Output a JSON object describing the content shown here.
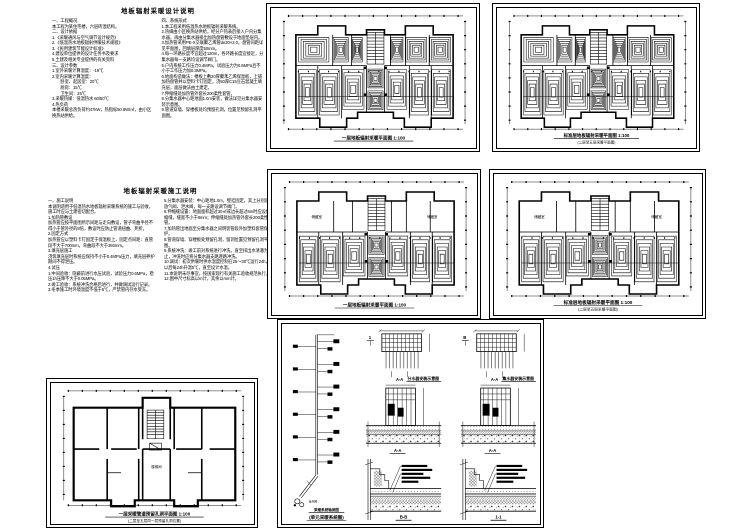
{
  "page": {
    "background": "#ffffff",
    "ink": "#000000"
  },
  "notes_top": {
    "title": "地板辐射采暖设计说明",
    "col_left": "一、工程概况\n本工程为某住宅楼，六层砖混结构。\n二、设计依据\n1.《采暖通风与空气调节设计规范》\n2.《低温热水地板辐射供暖技术规程》\n3.《民用建筑节能设计标准》\n4.建设单位提供的设计任务书及要求\n5.土建及相关专业提供的有关资料\n三、设计参数\n1.室外采暖计算温度：-19℃\n2.室内采暖计算温度：\n　　卧室、起居室：20℃\n　　厨房：15℃\n　　卫生间：25℃\n3.采暖热媒：低温热水 60/50℃\n4.热负荷\n本楼采暖总热负荷约47kW，热指标50.8W/㎡，由小区换热站供给。",
    "col_right": "四、系统形式\n1.本工程采用低温热水地板辐射采暖系统。\n2.热媒由小区换热站供给，经分户热表后接入户内分集水器，再由分集水器接出加热盘管敷设于地面垫层内。\n3.加热管采用PE-X交联聚乙烯管de20×2.0，盘管间距详见平面图，回填层厚度50mm。\n4.每一环路长度不宜超过120m，各环路长度宜接近，分集水器每一支路均设调节阀门。\n5.户内系统工作压力0.4MPa，试验压力为0.6MPa且不小于工作压力加0.3MPa。\n6.地面构造做法：楼板上敷20厚聚苯乙烯保温板，上铺加热盘管并以塑料卡钉固定，浇50厚C15豆石混凝土填充层，面层做法由土建定。\n7.伸缩缝处加热管外套长200柔性套管。\n8.分集水器中心距地面1.0m安装，做法详见分集水器安装示意图。\n9.管道穿墙、穿楼板处均预留孔洞，位置见预留孔洞平面图。"
  },
  "notes_mid": {
    "title": "地板辐射采暖施工说明",
    "col_left": "一、施工说明\n本说明适用于低温热水地板辐射采暖系统的施工与验收，施工时应与土建密切配合。\n1.加热管敷设\n加热管应按平面图所示间距与走向敷设，管子弯曲半径不得小于管外径的8倍，敷设时应防止管道扭曲、死折。\n2.固定方式\n加热管应以塑料卡钉固定于保温板上，固定点间距：直管段不大于700mm，弯曲段不大于350mm。\n3.填充层施工\n浇筑填充层时系统应保持不小于0.4MPa压力，填充层养护期间不得泄压。\n4.试压\n1.中间验收：隐蔽前进行水压试验，试验压力0.6MPa，稳压1h压降不大于0.05MPa。\n2.竣工验收：系统冲洗合格后进行，并做调试运行记录。\n3.冬季施工时环境温度不低于5℃，严禁管内存水受冻。",
    "col_right": "5.分集水器安装：中心距地1.0m，壁挂固定，其上分别设放气阀、泄水阀，每一支路设调节阀门。\n6.伸缩缝设置：地面面积超过30㎡或边长超过6m时应设伸缩缝，缝宽不小于8mm；伸缩缝处加热管外套长200柔性套管。\n7.加热管出地面至分集水器之间明装管段外加塑料套管保护。\n8.管道穿墙、穿楼板处预留孔洞，留洞位置见预留孔洞平面图。\n9.系统冲洗：竣工前对系统进行冲洗，直至排出水清澈为止，冲洗时应将分集水器支路逐路冲洗。\n10.调试：初次供暖时供水温度控制在25～30℃运行24h，以后每24h升温5℃，直至设计水温。\n11.本说明未尽事宜，按国家现行有关施工验收规范执行。\n12.图中尺寸标高以m计，其余以mm计。"
  },
  "plan_top_mid": {
    "caption": "一层地板辐射采暖平面图 1:100"
  },
  "plan_top_right": {
    "caption": "标准层地板辐射采暖平面图 1:100",
    "subcaption": "(二层至五层采暖平面图)"
  },
  "plan_mid_center": {
    "caption": "一层地板辐射采暖平面图 1:100",
    "room_left": "储藏室",
    "room_right": "储藏室"
  },
  "plan_mid_right": {
    "caption": "标准层地板辐射采暖平面图 1:100",
    "subcaption": "(二层至五层采暖平面图)",
    "room_left": "储藏室",
    "room_right": "储藏室"
  },
  "plan_bottom_left": {
    "caption": "一层采暖管道预留孔洞平面图 1:100",
    "subcaption": "(二层至五层同一层预留孔洞位置)",
    "stair_label": "楼梯间"
  },
  "details": {
    "riser_caption": "采暖系统轴测图",
    "riser_subcaption": "(单元采暖系统图)",
    "riser_note": "接外网",
    "supply_manifold_title": "分水器安装示意图",
    "return_manifold_title": "集水器安装示意图",
    "mark_aa": "A-A",
    "mark_bb": "B-B",
    "mark_11": "1-1",
    "cut_left": "1",
    "cut_right": "B"
  }
}
